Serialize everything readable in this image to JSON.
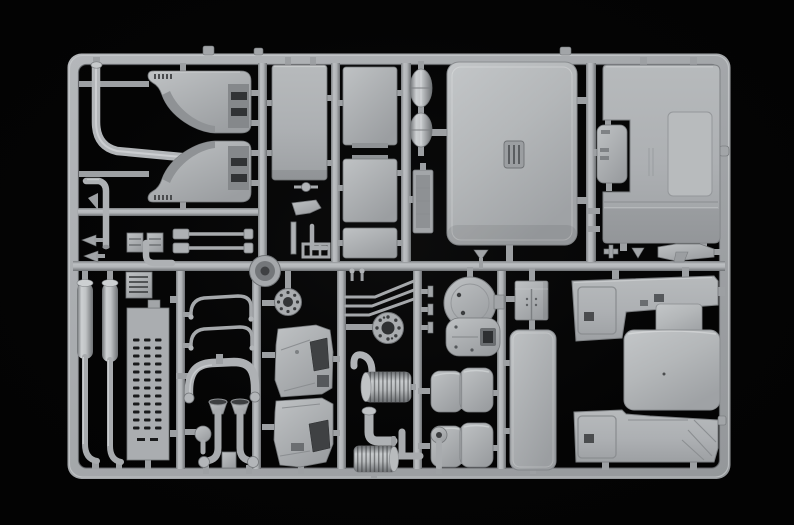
{
  "meta": {
    "domain": "Natural-Image",
    "subject": "Plastic model kit sprue",
    "aria_label": "Light grey plastic model kit sprue holding unassembled truck parts, photographed on a black background",
    "description": "Overhead product photo of a single light-grey injection-moulded styrene sprue (parts runner) from a truck model kit. The rounded rectangular runner frame is divided by a centre rail into two rows packed with parts: cab roof and rear panels, wheel-arch liners, bent exhaust pipes, rectangular tank panels, a small door, exhaust stacks, a perforated step plate, hoses, intake funnels, dashboard cowls, bolt flanges, tank end caps, a battery box, a bunk panel, two seat cushions and the cab floor with engine tunnel."
  },
  "colors": {
    "background": "#030303",
    "base": "#a9acaf",
    "light": "#c4c7c9",
    "lighter": "#d6d8da",
    "mid": "#94979a",
    "dark": "#76797c",
    "deep": "#57595c",
    "recess": "#3a3c3e",
    "hole": "#161718"
  },
  "sprue": {
    "material": "light grey styrene",
    "backdrop": "black studio background",
    "frame_shape": "rounded rectangle runner frame with one horizontal centre rail and multiple vertical rails",
    "parts": [
      {
        "id": "bent-exhaust-pipe",
        "label": "Large S-bent exhaust pipe"
      },
      {
        "id": "elbow-pipe",
        "label": "Small elbow pipe"
      },
      {
        "id": "wheel-arch-upper",
        "label": "Upper wheel-arch liner"
      },
      {
        "id": "wheel-arch-lower",
        "label": "Lower wheel-arch liner"
      },
      {
        "id": "tall-panel",
        "label": "Tall rectangular panel"
      },
      {
        "id": "panel-1",
        "label": "Rectangular panel 1"
      },
      {
        "id": "panel-2",
        "label": "Rectangular panel 2"
      },
      {
        "id": "panel-3",
        "label": "Rectangular panel 3"
      },
      {
        "id": "air-tank-1",
        "label": "Oval air tank"
      },
      {
        "id": "air-tank-2",
        "label": "Oval air tank"
      },
      {
        "id": "radiator-core",
        "label": "Narrow radiator core"
      },
      {
        "id": "cab-roof-panel",
        "label": "Cab roof panel with sunroof hatch"
      },
      {
        "id": "small-door",
        "label": "Small hatch door"
      },
      {
        "id": "cab-rear-panel",
        "label": "Large cab rear panel"
      },
      {
        "id": "nozzle-bracket",
        "label": "Angled nozzle bracket"
      },
      {
        "id": "hinge-blocks",
        "label": "Ribbed hinge blocks"
      },
      {
        "id": "linkage-rods",
        "label": "Linkage rods"
      },
      {
        "id": "bone-rod",
        "label": "Rod with centre knob"
      },
      {
        "id": "boot-wedge",
        "label": "Wedge-shaped fitting"
      },
      {
        "id": "ladder-bracket",
        "label": "Small ladder bracket"
      },
      {
        "id": "fan-disc",
        "label": "Round fan / pulley disc"
      },
      {
        "id": "exhaust-stack-left",
        "label": "Vertical exhaust stack"
      },
      {
        "id": "exhaust-stack-right",
        "label": "Vertical exhaust stack"
      },
      {
        "id": "intercooler-block",
        "label": "Finned intercooler block"
      },
      {
        "id": "perforated-plate",
        "label": "Perforated step plate"
      },
      {
        "id": "thin-hose-1",
        "label": "Thin bent hose"
      },
      {
        "id": "thin-hose-2",
        "label": "Thin bent hose"
      },
      {
        "id": "u-hose",
        "label": "Thick U-shaped hose"
      },
      {
        "id": "intake-funnel-left",
        "label": "Intake funnel tube"
      },
      {
        "id": "intake-funnel-right",
        "label": "Intake funnel tube"
      },
      {
        "id": "ball-elbow",
        "label": "Ball-joint elbow"
      },
      {
        "id": "bolt-flange-small",
        "label": "Small bolt-circle flange"
      },
      {
        "id": "bolt-flange-large",
        "label": "Large bolt-circle flange"
      },
      {
        "id": "wiper-rods",
        "label": "Three bent wire rods"
      },
      {
        "id": "plug-fittings",
        "label": "Plug fittings"
      },
      {
        "id": "dashboard-upper",
        "label": "Dashboard cowl panel"
      },
      {
        "id": "dashboard-lower",
        "label": "Dashboard cowl panel"
      },
      {
        "id": "tank-cap-round",
        "label": "Round tank end cap"
      },
      {
        "id": "tank-cap-square",
        "label": "Square tank end cap"
      },
      {
        "id": "battery-box",
        "label": "Battery box with doors"
      },
      {
        "id": "bunk-panel",
        "label": "Long rounded bunk panel"
      },
      {
        "id": "seat-upper",
        "label": "Seat cushion"
      },
      {
        "id": "seat-lower",
        "label": "Seat cushion"
      },
      {
        "id": "air-cleaner-drum",
        "label": "Ribbed air-cleaner drum with hose"
      },
      {
        "id": "thick-elbow",
        "label": "Thick elbow pipe with flange"
      },
      {
        "id": "ribbed-canister",
        "label": "Ribbed canister"
      },
      {
        "id": "l-bracket",
        "label": "L bracket"
      },
      {
        "id": "flange-pipe",
        "label": "Flanged pipe stub"
      },
      {
        "id": "tree-clips",
        "label": "Fir-tree clips"
      },
      {
        "id": "stud-pins",
        "label": "Small stud pins"
      }
    ]
  }
}
